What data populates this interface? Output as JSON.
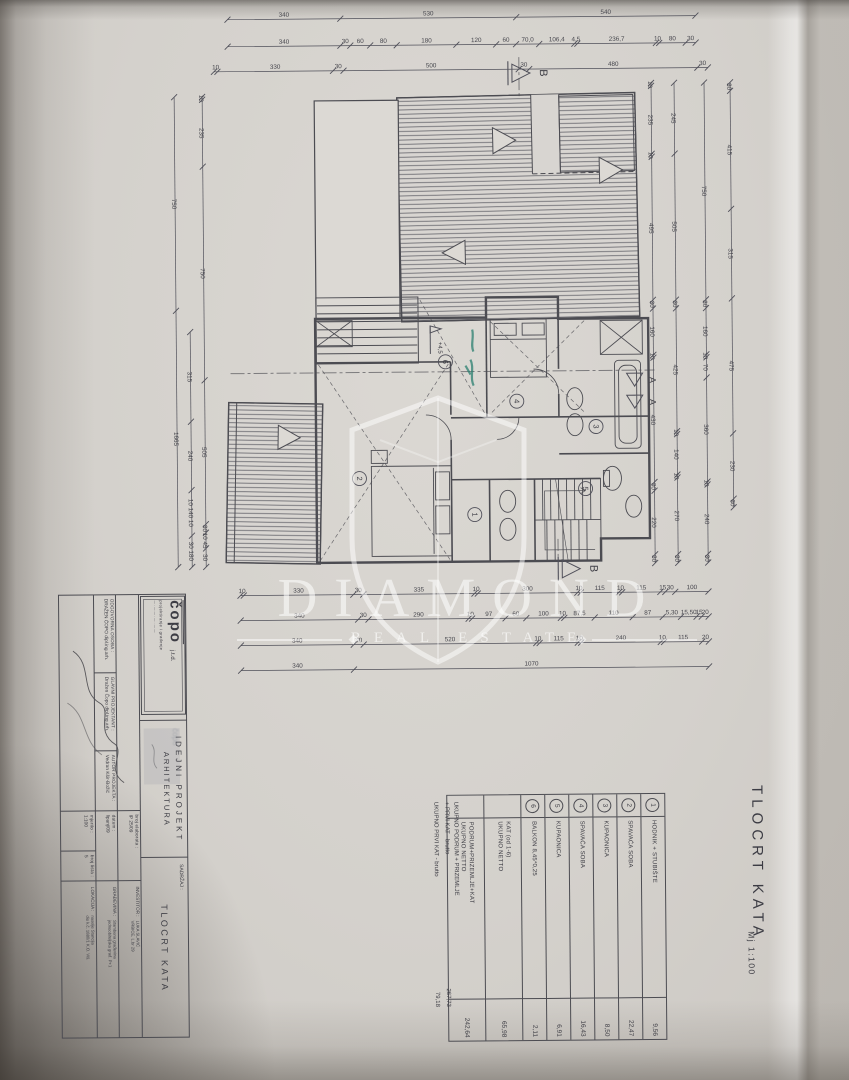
{
  "watermark": {
    "title": "DIAMOND",
    "subtitle": "REAL ESTATE"
  },
  "sheet": {
    "title": "TLOCRT KATA",
    "scale": "Mj 1:100"
  },
  "title_block": {
    "logo": {
      "name": "čopo",
      "suffix": "j.t.d.",
      "tagline": "projektiranje i građenje",
      "tagline2": "— · —  — · — · —  —"
    },
    "persons": [
      {
        "label": "ODGOVORNA OSOBA :",
        "value": "DRAŽEN ČOPO dipl.ing.arh."
      },
      {
        "label": "GLAVNI PROJEKTANT :",
        "value": "Dražen Čopo dipl.ing.arh."
      },
      {
        "label": "AUTOR PROJEKTA :",
        "value": "Vedran Kšir-Božić"
      }
    ],
    "phase": {
      "line1": "IDEJNI  PROJEKT",
      "line2": "ARHITEKTURA"
    },
    "fields": [
      {
        "label": "broj elaborata :",
        "value": "IP  25/09"
      },
      {
        "label": "datum :",
        "value": "lipanj/09"
      },
      {
        "label": "mjerilo :",
        "value": "1:100"
      },
      {
        "label": "broj lista :",
        "value": "5"
      }
    ],
    "sadrzaj": {
      "label": "SADRŽAJ :",
      "value": "TLOCRT KATA"
    },
    "parties": [
      {
        "label": "INVESTITOR :",
        "v1": "LUKA SLAVIĆ",
        "v2": "VRBICE, L.br 29"
      },
      {
        "label": "GRAĐEVINA :",
        "v1": "Stambena građevina",
        "v2": "jednoobiteljska građ. P+1"
      },
      {
        "label": "LOKACIJA :",
        "v1": "naselje Stancija",
        "v2": "dio k.č. 1880/1 K.O. Viš."
      }
    ]
  },
  "legend": {
    "rows": [
      {
        "no": "1",
        "name": "HODNIK + STUBIŠTE",
        "name2": "",
        "area": "9,56"
      },
      {
        "no": "2",
        "name": "SPAVAĆA SOBA",
        "name2": "",
        "area": "22,47"
      },
      {
        "no": "3",
        "name": "KUPAONICA",
        "name2": "",
        "area": "8,50"
      },
      {
        "no": "4",
        "name": "SPAVAĆA SOBA",
        "name2": "",
        "area": "16,43"
      },
      {
        "no": "5",
        "name": "KUPAONICA",
        "name2": "",
        "area": "6,91"
      },
      {
        "no": "6",
        "name": "BALKON 8,45*0,25",
        "name2": "",
        "area": "2,11"
      },
      {
        "no": "",
        "name": "KAT (od 1-6)",
        "name2": "UKUPNO NETTO",
        "area": "65,98"
      },
      {
        "no": "",
        "name": "PODRUM+PRIZEMLJE+KAT",
        "name2": "UKUPNO NETTO",
        "area": "242,64"
      }
    ],
    "totals": [
      {
        "l1": "UKUPNO PODRUM + PRIZEMLJE",
        "l2": "+ PRVI KAT - brutto",
        "value": "267,73"
      },
      {
        "l1": "UKUPNO PRVI KAT - brutto",
        "l2": "",
        "value": "79,18"
      }
    ]
  },
  "rooms": [
    {
      "n": "1",
      "x": 475,
      "y": 515
    },
    {
      "n": "2",
      "x": 360,
      "y": 478
    },
    {
      "n": "3",
      "x": 597,
      "y": 428
    },
    {
      "n": "4",
      "x": 518,
      "y": 402
    },
    {
      "n": "5",
      "x": 586,
      "y": 490
    },
    {
      "n": "6",
      "x": 447,
      "y": 362
    }
  ],
  "level_mark": {
    "text": "+4,5",
    "x": 432,
    "y": 326
  },
  "markers": [
    {
      "letter": "B",
      "x": 512,
      "y": 74,
      "dir": "right"
    },
    {
      "letter": "B",
      "x": 558,
      "y": 570,
      "dir": "right"
    },
    {
      "letter": "A",
      "x": 636,
      "y": 382,
      "dir": "down"
    },
    {
      "letter": "A",
      "x": 636,
      "y": 404,
      "dir": "down"
    }
  ],
  "dimensions": {
    "chains": [
      {
        "o": "h",
        "at": 18,
        "from": 232,
        "to": 700,
        "segs": [
          [
            "340",
            340
          ],
          [
            "530",
            530
          ],
          [
            "540",
            540
          ]
        ]
      },
      {
        "o": "h",
        "at": 45,
        "from": 232,
        "to": 700,
        "segs": [
          [
            "340",
            340
          ],
          [
            "30",
            30
          ],
          [
            "60",
            60
          ],
          [
            "80",
            80
          ],
          [
            "180",
            180
          ],
          [
            "120",
            120
          ],
          [
            "60",
            60
          ],
          [
            "70,0",
            70
          ],
          [
            "106,4",
            106
          ],
          [
            "4,5",
            9
          ],
          [
            "236,7",
            237
          ],
          [
            "10",
            10
          ],
          [
            "80",
            80
          ],
          [
            "30",
            30
          ]
        ]
      },
      {
        "o": "h",
        "at": 70,
        "from": 218,
        "to": 712,
        "segs": [
          [
            "10",
            10
          ],
          [
            "330",
            330
          ],
          [
            "30",
            30
          ],
          [
            "500",
            500
          ],
          [
            "30",
            30
          ],
          [
            "480",
            480
          ],
          [
            "30",
            30
          ]
        ]
      },
      {
        "o": "h",
        "at": 594,
        "from": 240,
        "to": 708,
        "segs": [
          [
            "10",
            10
          ],
          [
            "330",
            330
          ],
          [
            "30",
            30
          ],
          [
            "335",
            335
          ],
          [
            "10",
            10
          ],
          [
            "300",
            300
          ],
          [
            "10",
            10
          ],
          [
            "115",
            115
          ],
          [
            "10",
            10
          ],
          [
            "115",
            115
          ],
          [
            "15",
            15
          ],
          [
            "30",
            30
          ],
          [
            "100",
            100
          ]
        ]
      },
      {
        "o": "h",
        "at": 619,
        "from": 240,
        "to": 708,
        "segs": [
          [
            "340",
            340
          ],
          [
            "30",
            30
          ],
          [
            "290",
            290
          ],
          [
            "10",
            10
          ],
          [
            "97",
            97
          ],
          [
            "60",
            60
          ],
          [
            "100",
            100
          ],
          [
            "10",
            10
          ],
          [
            "87,5",
            88
          ],
          [
            "110",
            110
          ],
          [
            "87",
            87
          ],
          [
            "5,30",
            53
          ],
          [
            "15,50",
            45
          ],
          [
            "15",
            15
          ],
          [
            "20",
            20
          ]
        ]
      },
      {
        "o": "h",
        "at": 644,
        "from": 240,
        "to": 708,
        "segs": [
          [
            "340",
            340
          ],
          [
            "30",
            30
          ],
          [
            "520",
            520
          ],
          [
            "10",
            10
          ],
          [
            "115",
            115
          ],
          [
            "10",
            10
          ],
          [
            "240",
            240
          ],
          [
            "10",
            10
          ],
          [
            "115",
            115
          ],
          [
            "20",
            20
          ]
        ]
      },
      {
        "o": "h",
        "at": 669,
        "from": 240,
        "to": 708,
        "segs": [
          [
            "340",
            340
          ],
          [
            "1070",
            1070
          ]
        ]
      },
      {
        "o": "v",
        "at": 206,
        "from": 95,
        "to": 565,
        "segs": [
          [
            "10",
            10
          ],
          [
            "235",
            235
          ],
          [
            "750",
            750
          ],
          [
            "505",
            505
          ],
          [
            "30",
            30
          ],
          [
            "10 45",
            55
          ],
          [
            "30",
            65
          ]
        ]
      },
      {
        "o": "v",
        "at": 178,
        "from": 95,
        "to": 565,
        "segs": [
          [
            "750",
            750
          ],
          [
            "1665",
            900
          ]
        ]
      },
      {
        "o": "v",
        "at": 192,
        "from": 330,
        "to": 565,
        "segs": [
          [
            "315",
            315
          ],
          [
            "240",
            240
          ],
          [
            "10 140 10",
            160
          ],
          [
            "30 180",
            110
          ]
        ]
      },
      {
        "o": "v",
        "at": 655,
        "from": 85,
        "to": 565,
        "segs": [
          [
            "10",
            10
          ],
          [
            "235",
            235
          ],
          [
            "10",
            10
          ],
          [
            "495",
            495
          ],
          [
            "30",
            30
          ],
          [
            "160",
            160
          ],
          [
            "10",
            10
          ],
          [
            "430",
            430
          ],
          [
            "30",
            30
          ],
          [
            "220",
            220
          ],
          [
            "30",
            30
          ]
        ]
      },
      {
        "o": "v",
        "at": 678,
        "from": 85,
        "to": 565,
        "segs": [
          [
            "245",
            245
          ],
          [
            "505",
            505
          ],
          [
            "30",
            30
          ],
          [
            "425",
            425
          ],
          [
            "10",
            10
          ],
          [
            "140",
            140
          ],
          [
            "10",
            10
          ],
          [
            "270",
            265
          ],
          [
            "30",
            30
          ]
        ]
      },
      {
        "o": "v",
        "at": 708,
        "from": 85,
        "to": 565,
        "segs": [
          [
            "750",
            750
          ],
          [
            "30",
            30
          ],
          [
            "160",
            160
          ],
          [
            "10",
            10
          ],
          [
            "70",
            70
          ],
          [
            "360",
            360
          ],
          [
            "10",
            10
          ],
          [
            "240",
            240
          ],
          [
            "30",
            30
          ]
        ]
      },
      {
        "o": "v",
        "at": 734,
        "from": 85,
        "to": 510,
        "segs": [
          [
            "30",
            30
          ],
          [
            "415",
            415
          ],
          [
            "315",
            315
          ],
          [
            "475",
            475
          ],
          [
            "230",
            230
          ],
          [
            "30",
            30
          ]
        ]
      }
    ]
  }
}
